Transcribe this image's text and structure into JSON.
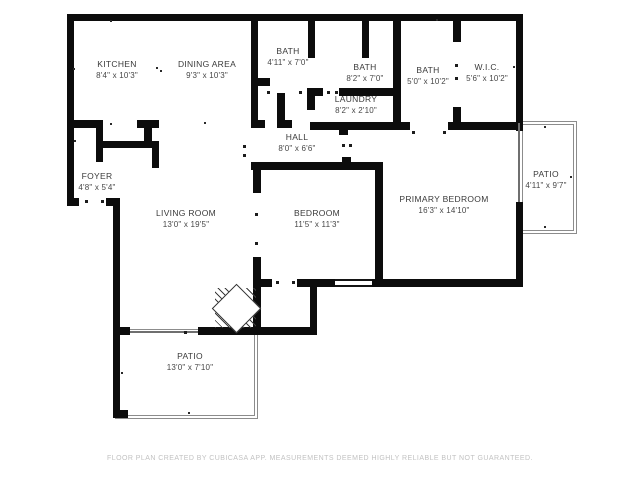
{
  "plan_title": "Apartment floor plan",
  "rooms": [
    {
      "name": "KITCHEN",
      "dims": "8'4\" x 10'3\""
    },
    {
      "name": "DINING AREA",
      "dims": "9'3\" x 10'3\""
    },
    {
      "name": "BATH",
      "dims": "4'11\" x 7'0\""
    },
    {
      "name": "BATH",
      "dims": "8'2\" x 7'0\""
    },
    {
      "name": "LAUNDRY",
      "dims": "8'2\" x 2'10\""
    },
    {
      "name": "BATH",
      "dims": "5'0\" x 10'2\""
    },
    {
      "name": "W.I.C.",
      "dims": "5'6\" x 10'2\""
    },
    {
      "name": "HALL",
      "dims": "8'0\" x 6'6\""
    },
    {
      "name": "FOYER",
      "dims": "4'8\" x 5'4\""
    },
    {
      "name": "LIVING ROOM",
      "dims": "13'0\" x 19'5\""
    },
    {
      "name": "BEDROOM",
      "dims": "11'5\" x 11'3\""
    },
    {
      "name": "PRIMARY BEDROOM",
      "dims": "16'3\" x 14'10\""
    },
    {
      "name": "PATIO",
      "dims": "4'11\" x 9'7\""
    },
    {
      "name": "PATIO",
      "dims": "13'0\" x 7'10\""
    }
  ],
  "footer": "FLOOR PLAN CREATED BY CUBICASA APP. MEASUREMENTS DEEMED HIGHLY RELIABLE BUT NOT GUARANTEED.",
  "colors": {
    "wall": "#0c0c0c",
    "room_text": "#3a3a3a",
    "footer_text": "#c2c2c2",
    "outdoor_outline": "#8c8c8c",
    "background": "#ffffff"
  }
}
